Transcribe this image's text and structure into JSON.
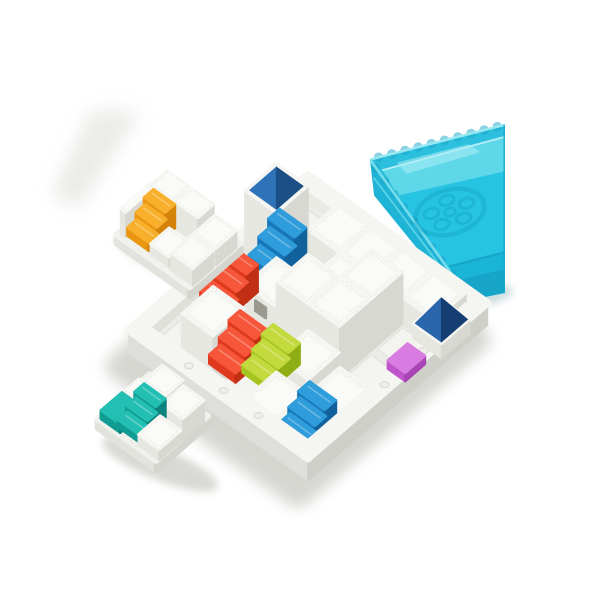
{
  "alt": "Product photo of a white castle-building logic puzzle: a square white board filled with white block towers and colored staircase pieces (red, blue, orange, teal, lime, magenta) with blue pyramid roofs, two loose white stair pieces beside it, and a translucent teal castle-wall storage tray at the top right.",
  "canvas": {
    "width": 600,
    "height": 600,
    "background": "#ffffff"
  },
  "iso": {
    "u": [
      31.6,
      22.6
    ],
    "v": [
      -31.6,
      27.4
    ],
    "h": 26
  },
  "palette": {
    "white_top": "#f6f6f3",
    "white_side_l": "#e7e7e2",
    "white_side_r": "#d8d8d2",
    "white_cap": "#fbfbf9",
    "base_top": "#f1f1ed",
    "base_l": "#e3e3de",
    "base_r": "#d5d5cf",
    "floor": "#ececе8",
    "floor_fix": "#ececе8",
    "floor_main": "#ececc8",
    "floor_col": "#ebebe7",
    "tile": "#f3f3ef",
    "tile_edge": "#e2e2db",
    "rim": "#f5f5f1",
    "wall_l": "#dededa",
    "wall_r": "#cfcfc9",
    "wall_inner_l": "#eaeae5",
    "wall_inner_r": "#e0e0db",
    "shadow": "#b5b5ad",
    "floor_shadow": "#6e6e68",
    "red": {
      "top": "#f6573a",
      "l": "#e03a1e",
      "r": "#c12f14"
    },
    "orange": {
      "top": "#f8b02c",
      "l": "#ea9612",
      "r": "#d3830a"
    },
    "blue": {
      "top": "#2f9ddb",
      "l": "#1877b8",
      "r": "#10619c"
    },
    "teal": {
      "top": "#23bfb2",
      "l": "#119c92",
      "r": "#0b827b"
    },
    "lime": {
      "top": "#c3da3e",
      "l": "#a6c41f",
      "r": "#8fae15"
    },
    "magenta": {
      "top": "#d97ce1",
      "l": "#c055cb",
      "r": "#a844b4"
    },
    "pyramid": {
      "l": "#2e72b8",
      "r": "#1c4f86",
      "top": "#2e72b8"
    },
    "pyramid2": {
      "l": "#2a66ac",
      "r": "#153f72",
      "top": "#2a66ac"
    },
    "window": "#99998f",
    "tray": {
      "base": "#2cc0de",
      "floor_back": "#5ed8e9",
      "floor_main": "#26c3e2",
      "floor_deep": "#1ab4d6",
      "wall": "#1fb3d6",
      "wall_low": "#17a5c9",
      "edge": "#9debf3",
      "bump": "#18a4ca",
      "line": "#0d90b5",
      "motif": "#149fc5",
      "glare": "#aeeff6",
      "cut": "#17a9ce"
    }
  },
  "board": {
    "name": "game-board",
    "origin": [
      308,
      206
    ],
    "cols": 5,
    "rows": 5,
    "wall": 0.34,
    "wall_h": 0.52,
    "base_depth": 0.3,
    "blocks": [
      {
        "i": 1,
        "j": 0,
        "h": 1
      },
      {
        "i": 2,
        "j": 0,
        "h": 1
      },
      {
        "i": 3,
        "j": 0,
        "h": 1
      },
      {
        "i": 4,
        "j": 0,
        "h": 1
      },
      {
        "i": 2,
        "j": 1,
        "h": 1
      },
      {
        "i": 3,
        "j": 1,
        "h": 2
      },
      {
        "i": 1,
        "j": 2,
        "h": 1,
        "window": true
      },
      {
        "i": 2,
        "j": 2,
        "h": 2
      },
      {
        "i": 3,
        "j": 2,
        "h": 2
      },
      {
        "i": 3,
        "j": 3,
        "h": 1
      },
      {
        "i": 4,
        "j": 3,
        "h": 0.45
      },
      {
        "i": 1,
        "j": 4,
        "h": 2
      },
      {
        "i": 3,
        "j": 4,
        "h": 0.45
      }
    ],
    "tower": {
      "i": 0,
      "j": 1,
      "h": 2.7,
      "name": "tall-tower"
    },
    "tower_pyramid": {
      "i0": 0.08,
      "j0": 1.08,
      "size": 0.84,
      "base": 2.7,
      "peak": 0.8,
      "pal": "pyramid",
      "name": "tower-pyramid-roof"
    },
    "stairs": [
      {
        "i": 0.55,
        "j": 1.45,
        "bottom": 0.8,
        "top": 1.9,
        "color": "blue",
        "name": "blue-stairs-tower"
      },
      {
        "i": 0.02,
        "j": 2.45,
        "bottom": 0.04,
        "top": 1.08,
        "color": "red",
        "name": "red-stairs-back"
      },
      {
        "i": 1.45,
        "j": 3.6,
        "bottom": 0.04,
        "top": 1.05,
        "color": "red",
        "name": "red-stairs-front"
      },
      {
        "i": 2.2,
        "j": 3.3,
        "bottom": 0.04,
        "top": 0.85,
        "color": "lime",
        "name": "lime-stairs"
      },
      {
        "i": 4.0,
        "j": 3.95,
        "bottom": 0.04,
        "top": 0.9,
        "color": "blue",
        "name": "blue-stairs-front"
      }
    ],
    "onwall": {
      "magenta_slab": {
        "i": 4.9,
        "j": 1.75,
        "di": 0.55,
        "dj": 0.62,
        "h0": 0.5,
        "h1": 0.82,
        "color": "magenta",
        "name": "magenta-piece"
      },
      "corner_block": {
        "i": 4.44,
        "j": 0.22,
        "di": 0.9,
        "dj": 0.9,
        "h0": -0.05,
        "h1": 0.52,
        "name": "corner-block"
      },
      "corner_pyramid": {
        "i0": 4.48,
        "j0": 0.26,
        "size": 0.82,
        "base": 0.52,
        "peak": 0.9,
        "pal": "pyramid2",
        "name": "corner-pyramid-roof"
      }
    },
    "floor_shadows": [
      [
        252,
        288,
        26,
        9
      ],
      [
        230,
        350,
        20,
        7
      ],
      [
        205,
        336,
        24,
        8
      ],
      [
        320,
        382,
        26,
        8
      ],
      [
        362,
        330,
        20,
        7
      ]
    ],
    "studs_front_left": [
      0.28,
      0.5,
      0.72
    ],
    "studs_front_right": [
      0.3,
      0.55
    ]
  },
  "pieces": [
    {
      "name": "orange-stairs-piece",
      "origin": [
        167,
        197
      ],
      "scale": 0.85,
      "base": {
        "i": -0.1,
        "j": -0.1,
        "di": 2.75,
        "dj": 1.9,
        "h0": -0.3,
        "h1": 0.1
      },
      "blocks": [
        {
          "i": 0,
          "j": 0,
          "di": 0.85,
          "dj": 0.6,
          "h": 1.2
        },
        {
          "i": 0.9,
          "j": 0,
          "di": 0.85,
          "dj": 0.6,
          "h": 1.2
        },
        {
          "i": -0.08,
          "j": 0.6,
          "di": 0.2,
          "dj": 1.05,
          "h": 1.15
        },
        {
          "i": 1.8,
          "j": 0.02,
          "di": 0.82,
          "dj": 0.78,
          "h": 0.78
        },
        {
          "i": 1.8,
          "j": 0.88,
          "di": 0.82,
          "dj": 0.78,
          "h": 0.78
        },
        {
          "i": 1.0,
          "j": 0.92,
          "di": 0.7,
          "dj": 0.7,
          "h": 0.45
        }
      ],
      "stairs": [
        {
          "i": 0.14,
          "j": 0.64,
          "len": 0.8,
          "bottom": 0.1,
          "top": 1.16,
          "color": "orange",
          "name": "orange-stairs"
        }
      ],
      "slabs": []
    },
    {
      "name": "teal-stairs-piece",
      "origin": [
        150,
        381
      ],
      "scale": 0.85,
      "base": {
        "i": -0.12,
        "j": -0.1,
        "di": 2.2,
        "dj": 1.95,
        "h0": -0.3,
        "h1": 0.12
      },
      "blocks": [
        {
          "i": 0.45,
          "j": 0,
          "di": 0.8,
          "dj": 0.68,
          "h": 1.12
        },
        {
          "i": 0,
          "j": 0.42,
          "di": 0.44,
          "dj": 0.52,
          "h": 0.55
        },
        {
          "i": 1.3,
          "j": 0.06,
          "di": 0.78,
          "dj": 0.8,
          "h": 1.0
        },
        {
          "i": 1.28,
          "j": 0.9,
          "di": 0.78,
          "dj": 0.82,
          "h": 0.5
        }
      ],
      "stairs": [
        {
          "i": 0.48,
          "j": 0.7,
          "len": 0.8,
          "bottom": 0.12,
          "top": 1.05,
          "color": "teal",
          "name": "teal-stairs"
        }
      ],
      "slabs": [
        {
          "i": -0.05,
          "j": 1.0,
          "di": 0.72,
          "dj": 0.78,
          "h0": 0.12,
          "h1": 0.5,
          "color": "teal",
          "name": "teal-corner-piece"
        }
      ]
    }
  ],
  "tray": {
    "name": "storage-tray-lid",
    "clip_x": 505,
    "silhouette": [
      [
        371,
        160
      ],
      [
        505,
        125
      ],
      [
        505,
        292
      ],
      [
        461,
        301
      ],
      [
        375,
        195
      ]
    ],
    "floor_back": [
      [
        384,
        171
      ],
      [
        505,
        138
      ],
      [
        505,
        174
      ],
      [
        399,
        196
      ]
    ],
    "floor_main": [
      [
        399,
        196
      ],
      [
        505,
        172
      ],
      [
        505,
        253
      ],
      [
        450,
        267
      ]
    ],
    "floor_deep": [
      [
        450,
        267
      ],
      [
        505,
        253
      ],
      [
        505,
        271
      ],
      [
        457,
        281
      ]
    ],
    "wall_left": [
      [
        371,
        160
      ],
      [
        457,
        281
      ],
      [
        461,
        301
      ],
      [
        375,
        195
      ]
    ],
    "wall_bottom": [
      [
        457,
        281
      ],
      [
        505,
        270
      ],
      [
        505,
        292
      ],
      [
        461,
        301
      ]
    ],
    "rim_top": [
      [
        372,
        159
      ],
      [
        504,
        125
      ]
    ],
    "rim_left": [
      [
        371,
        161
      ],
      [
        456,
        280
      ]
    ],
    "inner_line": [
      [
        383,
        170
      ],
      [
        504,
        137
      ]
    ],
    "seam": [
      [
        374,
        178
      ],
      [
        459,
        291
      ]
    ],
    "front_line": [
      [
        450,
        266
      ],
      [
        505,
        252
      ]
    ],
    "glare": [
      [
        398,
        163
      ],
      [
        468,
        145
      ],
      [
        479,
        152
      ],
      [
        407,
        173
      ]
    ],
    "bumps_top": {
      "n": 10,
      "r": 4.8
    },
    "bumps_left": {
      "n": 9,
      "r": 4.2
    },
    "motif": {
      "cx": 450,
      "cy": 212,
      "rx": 35,
      "ry": 22,
      "rot": -16,
      "holes": 5,
      "hole_rx": 7.5,
      "hole_ry": 5,
      "ring": 0.55
    }
  },
  "shadows": [
    {
      "type": "poly",
      "pts": [
        [
          58,
          192
        ],
        [
          94,
          116
        ],
        [
          132,
          116
        ],
        [
          76,
          202
        ]
      ],
      "fill": "#d7d7d1",
      "op": 0.5,
      "filter": "f3",
      "name": "ambient-shadow-top-left"
    },
    {
      "type": "ellipse",
      "cx": 178,
      "cy": 264,
      "rx": 66,
      "ry": 15,
      "rot": 22,
      "fill": "#b6b6ae",
      "op": 0.45,
      "filter": "f2",
      "name": "orange-piece-shadow"
    },
    {
      "type": "ellipse",
      "cx": 160,
      "cy": 464,
      "rx": 62,
      "ry": 16,
      "rot": 22,
      "fill": "#b2b2aa",
      "op": 0.5,
      "filter": "f2",
      "name": "teal-piece-shadow"
    },
    {
      "type": "ellipse",
      "cx": 484,
      "cy": 297,
      "rx": 30,
      "ry": 9,
      "rot": -14,
      "fill": "#9bbcc2",
      "op": 0.5,
      "filter": "f2",
      "name": "tray-shadow"
    }
  ]
}
